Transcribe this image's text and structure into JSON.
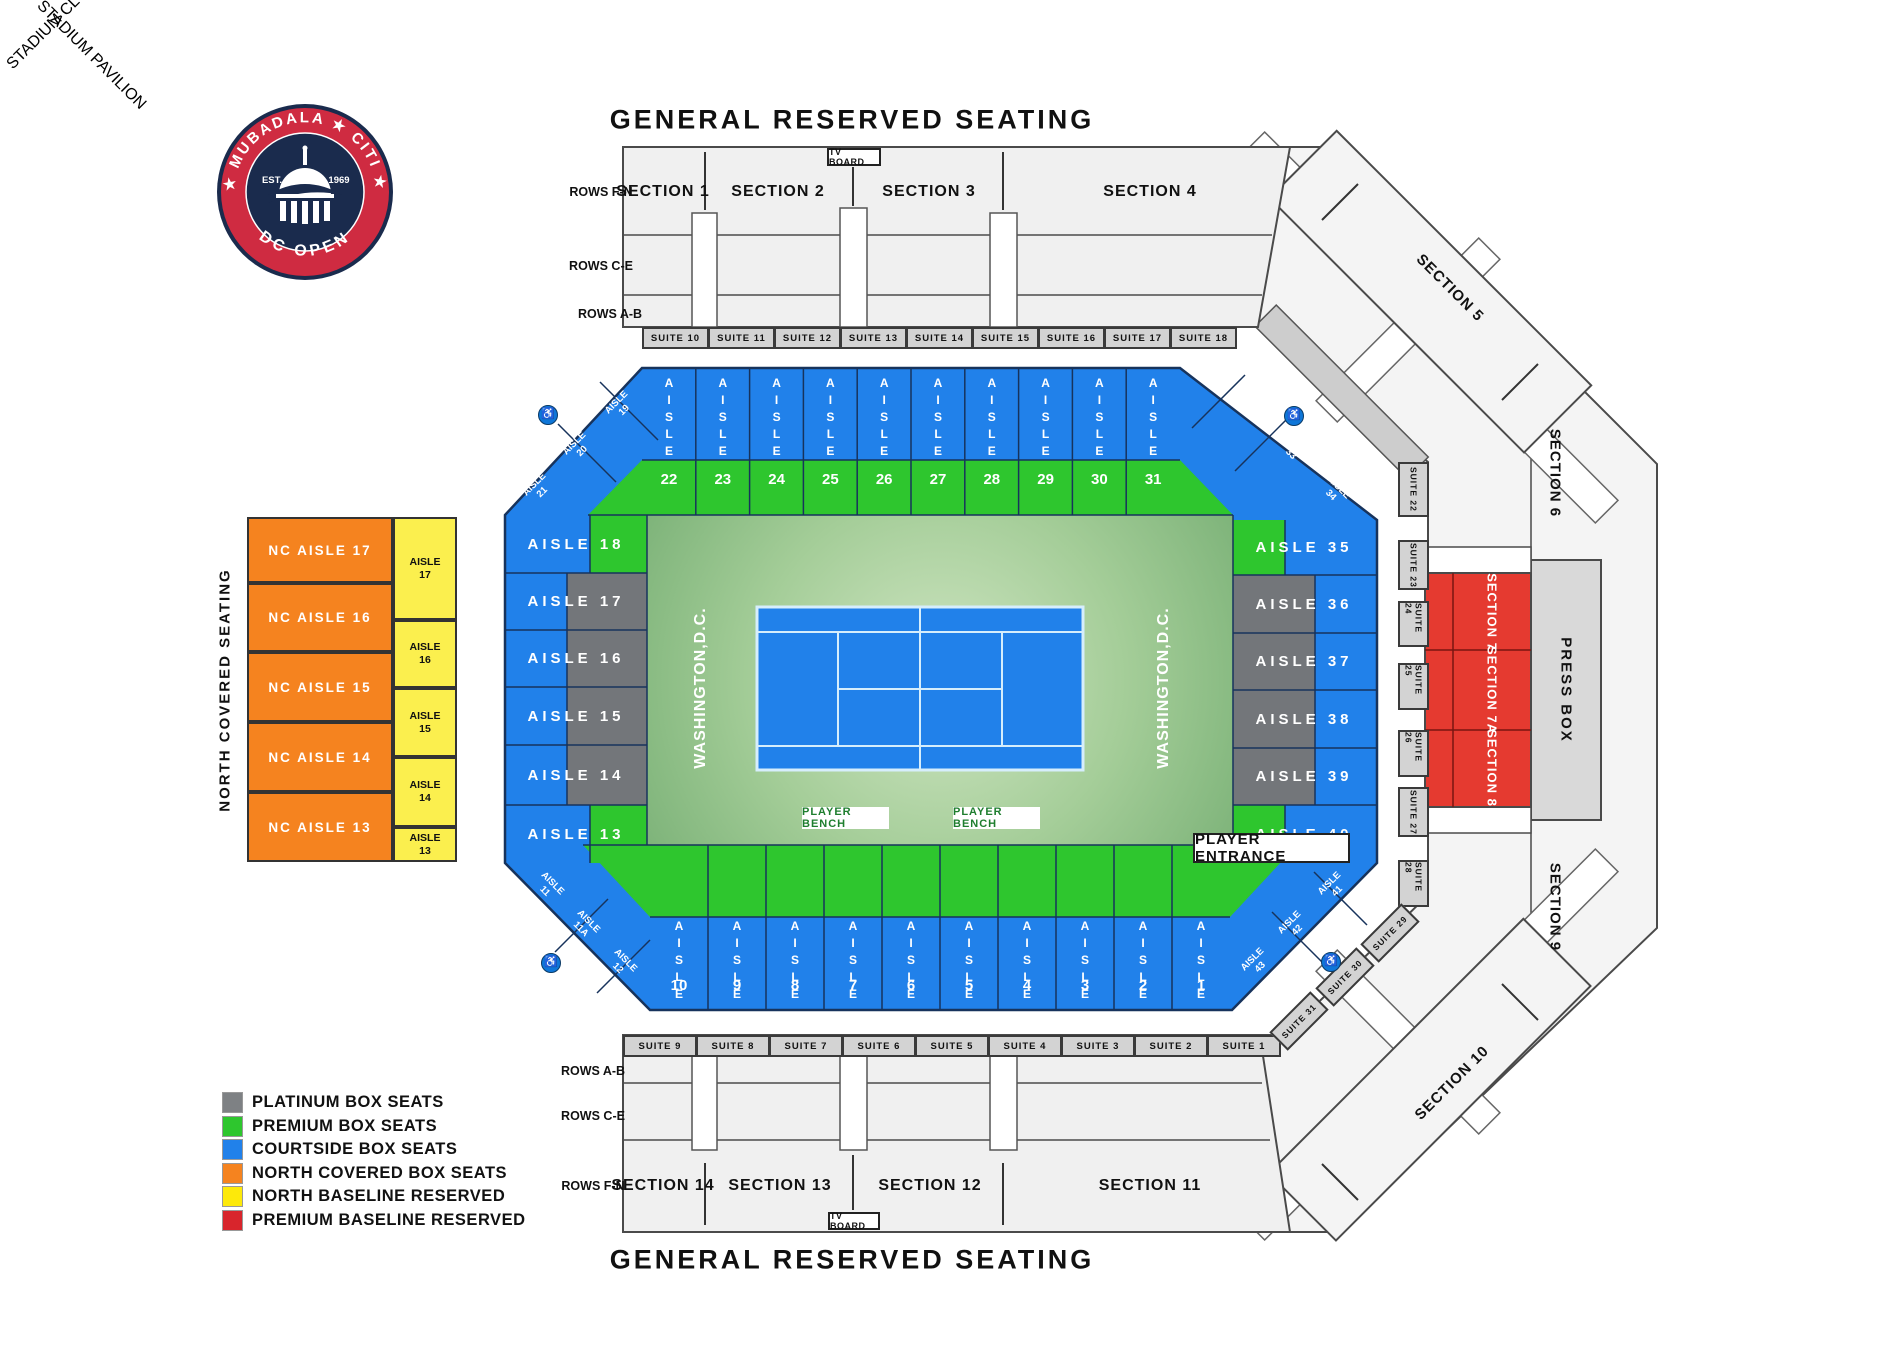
{
  "titles": {
    "top": "GENERAL RESERVED SEATING",
    "bottom": "GENERAL RESERVED SEATING"
  },
  "logo": {
    "arc_top": "★ MUBADALA ★ CITI ★",
    "arc_bottom": "DC OPEN",
    "est": "EST.",
    "year": "1969"
  },
  "top_stand": {
    "tv_board": "TV BOARD",
    "sections": [
      "SECTION 1",
      "SECTION 2",
      "SECTION 3",
      "SECTION 4"
    ],
    "row_labels": [
      "ROWS F-N",
      "ROWS C-E",
      "ROWS A-B"
    ],
    "suites": [
      "SUITE 10",
      "SUITE 11",
      "SUITE 12",
      "SUITE 13",
      "SUITE 14",
      "SUITE 15",
      "SUITE 16",
      "SUITE 17",
      "SUITE 18"
    ]
  },
  "bottom_stand": {
    "tv_board": "TV BOARD",
    "sections": [
      "SECTION 14",
      "SECTION 13",
      "SECTION 12",
      "SECTION 11"
    ],
    "row_labels": [
      "ROWS A-B",
      "ROWS C-E",
      "ROWS F-N"
    ],
    "suites": [
      "SUITE 9",
      "SUITE 8",
      "SUITE 7",
      "SUITE 6",
      "SUITE 5",
      "SUITE 4",
      "SUITE 3",
      "SUITE 2",
      "SUITE 1"
    ]
  },
  "right_ring": {
    "section5": "SECTION 5",
    "section6": "SECTION 6",
    "section9": "SECTION 9",
    "section10": "SECTION 10",
    "press_box": "PRESS BOX",
    "red_sections": [
      "SECTION 7",
      "SECTION 7A",
      "SECTION 8"
    ],
    "suite_column": [
      "SUITE 22",
      "SUITE 23",
      "SUITE 24",
      "SUITE 25",
      "SUITE 26",
      "SUITE 27",
      "SUITE 28"
    ],
    "suite_diagonal": [
      "SUITE 29",
      "SUITE 30",
      "SUITE 31"
    ]
  },
  "club": "STADIUM CLUB",
  "pavilion": "STADIUM PAVILION",
  "north_covered": {
    "side_label": "NORTH COVERED SEATING",
    "covered": [
      "NC AISLE 17",
      "NC AISLE 16",
      "NC AISLE 15",
      "NC AISLE 14",
      "NC AISLE 13"
    ],
    "baseline": [
      {
        "word": "AISLE",
        "num": "17"
      },
      {
        "word": "AISLE",
        "num": "16"
      },
      {
        "word": "AISLE",
        "num": "15"
      },
      {
        "word": "AISLE",
        "num": "14"
      },
      {
        "word": "AISLE",
        "num": "13"
      }
    ]
  },
  "bowl": {
    "top_cols": [
      {
        "word": "AISLE",
        "num": "22"
      },
      {
        "word": "AISLE",
        "num": "23"
      },
      {
        "word": "AISLE",
        "num": "24"
      },
      {
        "word": "AISLE",
        "num": "25"
      },
      {
        "word": "AISLE",
        "num": "26"
      },
      {
        "word": "AISLE",
        "num": "27"
      },
      {
        "word": "AISLE",
        "num": "28"
      },
      {
        "word": "AISLE",
        "num": "29"
      },
      {
        "word": "AISLE",
        "num": "30"
      },
      {
        "word": "AISLE",
        "num": "31"
      }
    ],
    "bottom_cols": [
      {
        "word": "AISLE",
        "num": "10"
      },
      {
        "word": "AISLE",
        "num": "9"
      },
      {
        "word": "AISLE",
        "num": "8"
      },
      {
        "word": "AISLE",
        "num": "7"
      },
      {
        "word": "AISLE",
        "num": "6"
      },
      {
        "word": "AISLE",
        "num": "5"
      },
      {
        "word": "AISLE",
        "num": "4"
      },
      {
        "word": "AISLE",
        "num": "3"
      },
      {
        "word": "AISLE",
        "num": "2"
      },
      {
        "word": "AISLE",
        "num": "1"
      }
    ],
    "left_rows": [
      "AISLE 18",
      "AISLE 17",
      "AISLE 16",
      "AISLE 15",
      "AISLE 14",
      "AISLE 13"
    ],
    "right_rows": [
      "AISLE 35",
      "AISLE 36",
      "AISLE 37",
      "AISLE 38",
      "AISLE 39",
      "AISLE 40"
    ],
    "corner_tl": [
      {
        "word": "AISLE",
        "num": "19"
      },
      {
        "word": "AISLE",
        "num": "20"
      },
      {
        "word": "AISLE",
        "num": "21"
      }
    ],
    "corner_tr": [
      {
        "word": "AISLE",
        "num": "32"
      },
      {
        "word": "AISLE",
        "num": "33"
      },
      {
        "word": "AISLE",
        "num": "34"
      }
    ],
    "corner_bl": [
      {
        "word": "AISLE",
        "num": "11"
      },
      {
        "word": "AISLE",
        "num": "11A"
      },
      {
        "word": "AISLE",
        "num": "12"
      }
    ],
    "corner_br": [
      {
        "word": "AISLE",
        "num": "41"
      },
      {
        "word": "AISLE",
        "num": "42"
      },
      {
        "word": "AISLE",
        "num": "43"
      }
    ],
    "city_label": "WASHINGTON,D.C.",
    "player_bench": "PLAYER BENCH",
    "player_entrance": "PLAYER ENTRANCE",
    "wheelchair_icon": "♿"
  },
  "legend": {
    "items": [
      {
        "label": "PLATINUM BOX SEATS",
        "color": "#7e8184"
      },
      {
        "label": "PREMIUM BOX SEATS",
        "color": "#2ec62e"
      },
      {
        "label": "COURTSIDE BOX SEATS",
        "color": "#2181ea"
      },
      {
        "label": "NORTH COVERED BOX SEATS",
        "color": "#f5831f"
      },
      {
        "label": "NORTH BASELINE RESERVED",
        "color": "#fde90a"
      },
      {
        "label": "PREMIUM BASELINE RESERVED",
        "color": "#d8252c"
      }
    ]
  }
}
